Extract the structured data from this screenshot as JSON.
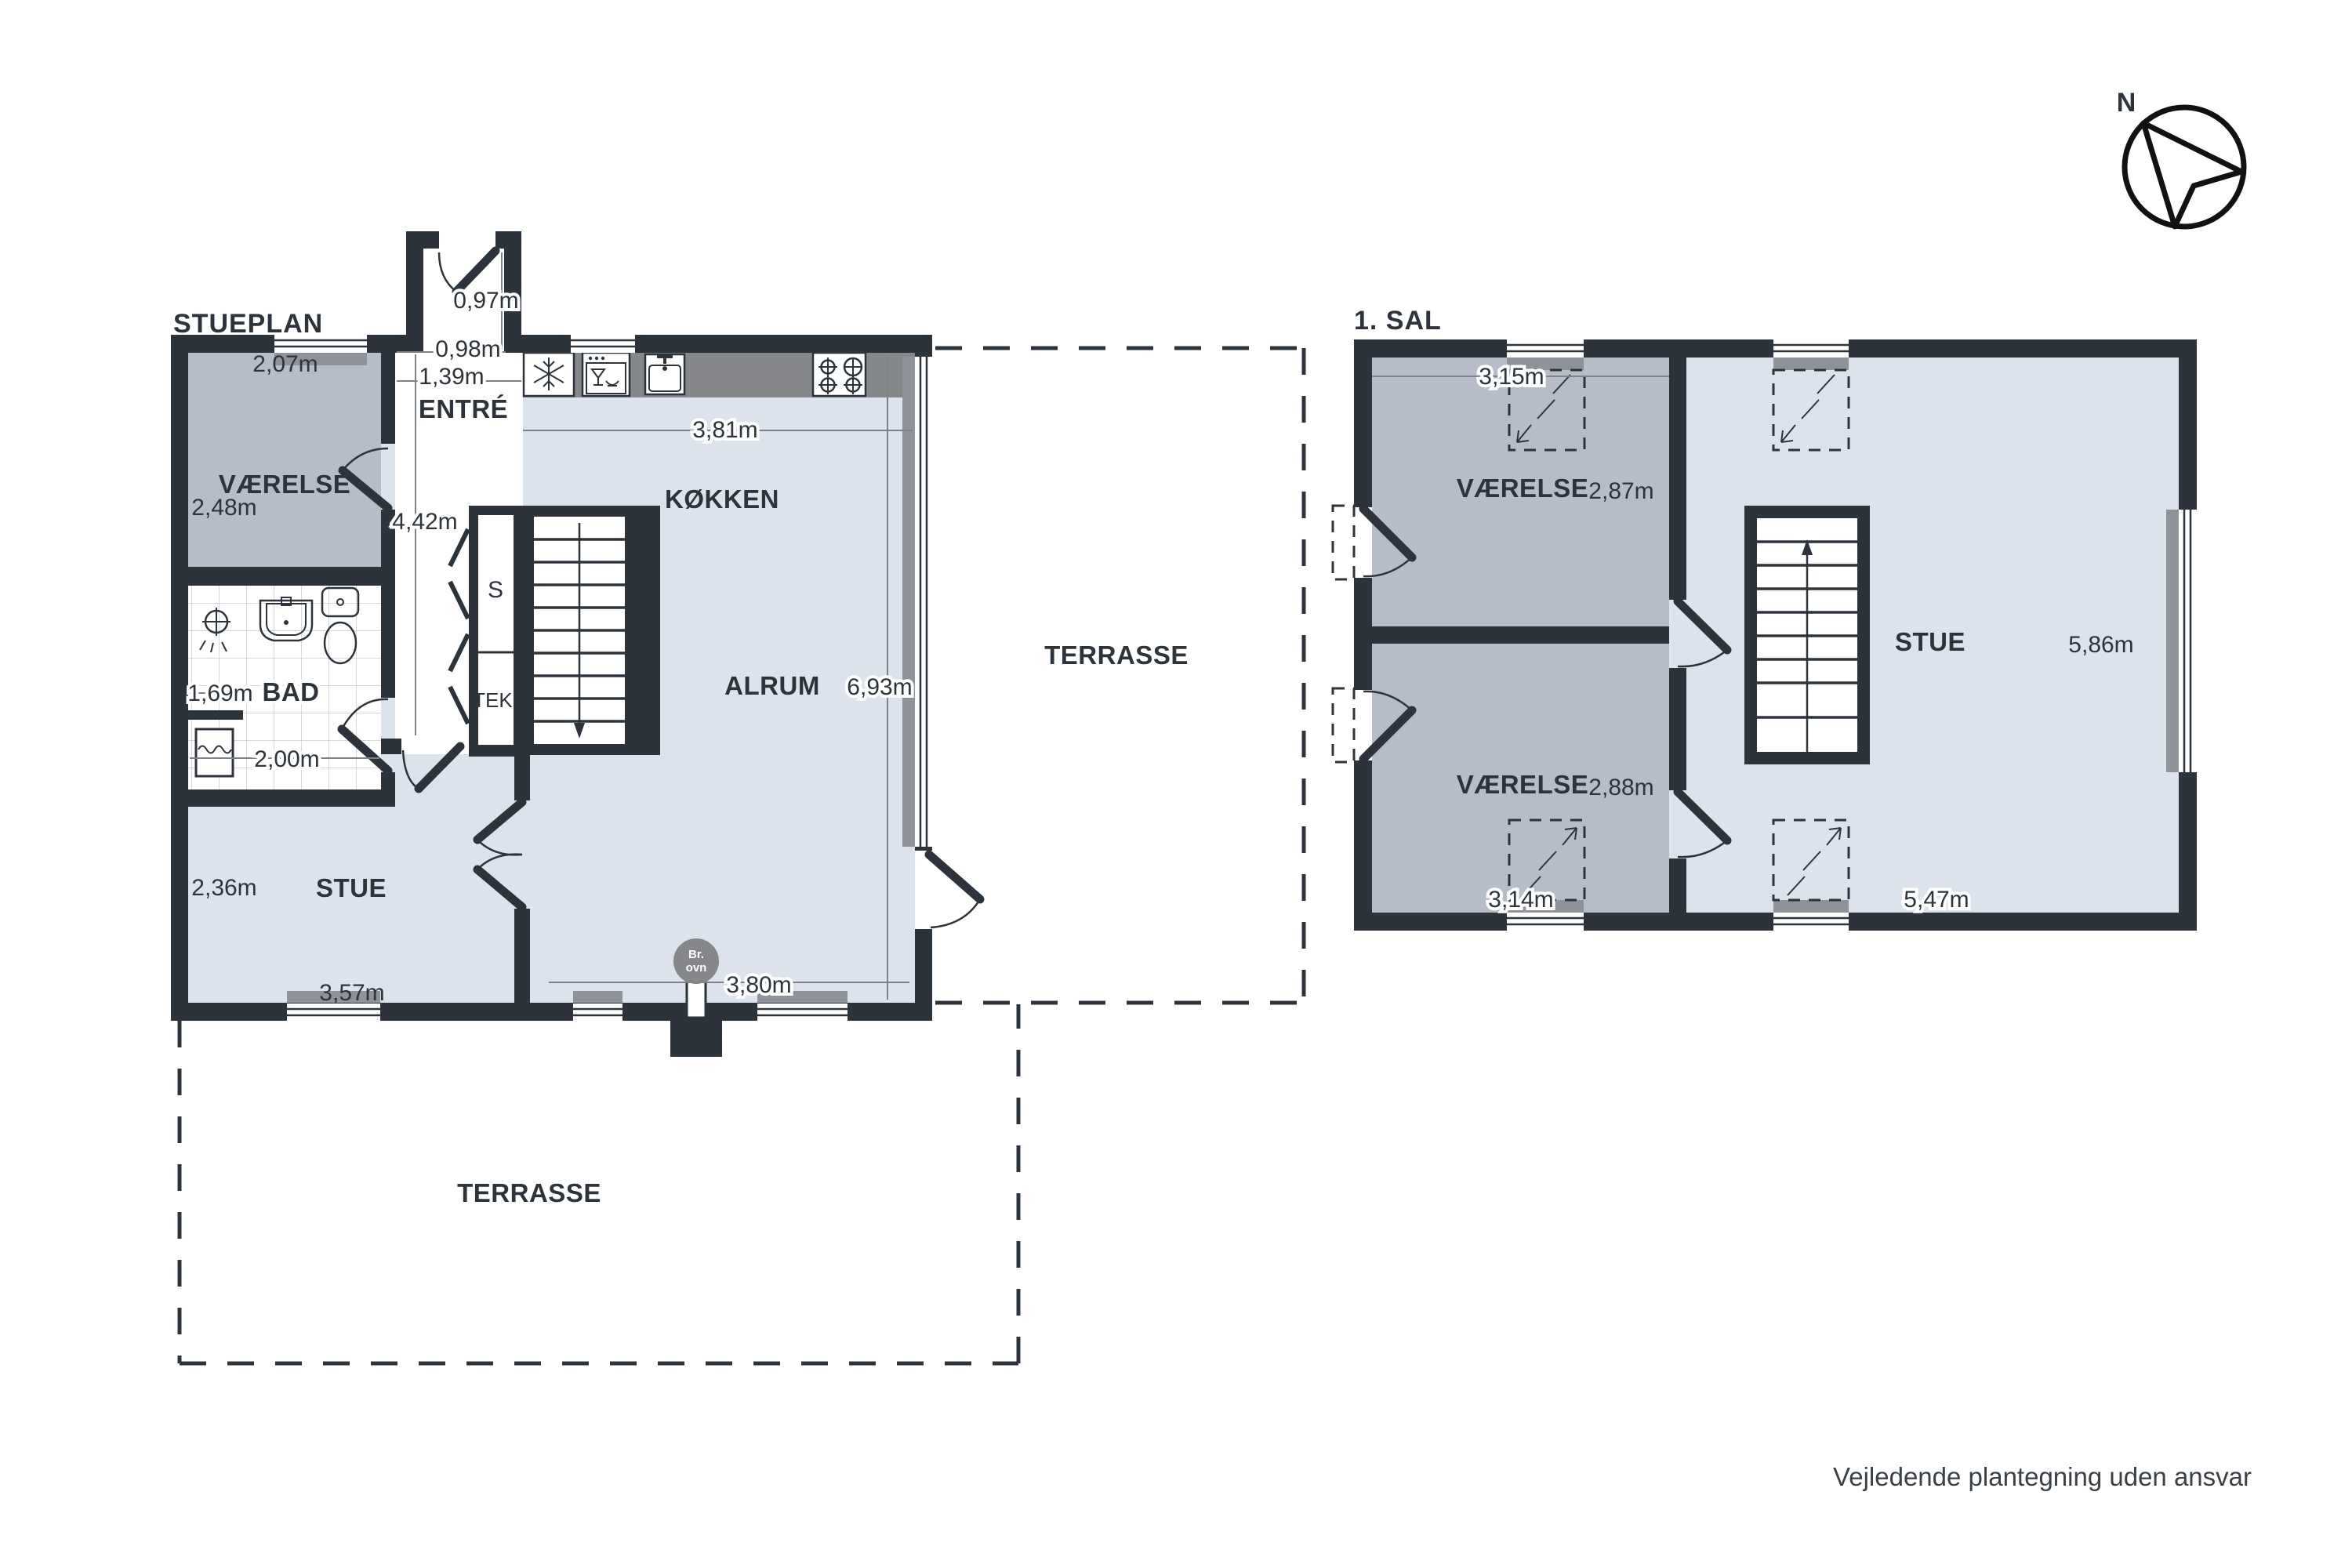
{
  "page": {
    "background": "#ffffff"
  },
  "footer": {
    "disclaimer": "Vejledende plantegning uden ansvar"
  },
  "compass": {
    "label": "N"
  },
  "colors": {
    "wall": "#2d333b",
    "floor_light": "#dce3ed",
    "floor_gray": "#b6bdc9",
    "counter": "#85878b",
    "sill": "#8e9399"
  },
  "stueplan": {
    "title": "STUEPLAN",
    "rooms": {
      "vaerelse": {
        "name": "VÆRELSE",
        "dim_top": "2,07m",
        "dim_left": "2,48m"
      },
      "entre": {
        "name": "ENTRÉ",
        "door_dim": "0,97m",
        "dim_depth": "0,98m",
        "dim_width": "1,39m",
        "dim_hall": "4,42m"
      },
      "koekken": {
        "name": "KØKKEN",
        "dim_top": "3,81m"
      },
      "alrum": {
        "name": "ALRUM",
        "dim_right": "6,93m",
        "dim_bottom": "3,80m"
      },
      "bad": {
        "name": "BAD",
        "dim_nook": "1,69m",
        "dim_width": "2,00m"
      },
      "stue": {
        "name": "STUE",
        "dim_left": "2,36m",
        "dim_bottom": "3,57m"
      },
      "terrasse_east": {
        "name": "TERRASSE"
      },
      "terrasse_south": {
        "name": "TERRASSE"
      },
      "closet": {
        "s": "S",
        "tek": "TEK."
      },
      "br_ovn": {
        "line1": "Br.",
        "line2": "ovn"
      }
    }
  },
  "sal": {
    "title": "1. SAL",
    "rooms": {
      "vaerelse_north": {
        "name": "VÆRELSE",
        "dim_top": "3,15m",
        "dim_right": "2,87m"
      },
      "vaerelse_south": {
        "name": "VÆRELSE",
        "dim_bottom": "3,14m",
        "dim_right": "2,88m"
      },
      "stue": {
        "name": "STUE",
        "dim_right": "5,86m",
        "dim_bottom": "5,47m"
      }
    }
  }
}
